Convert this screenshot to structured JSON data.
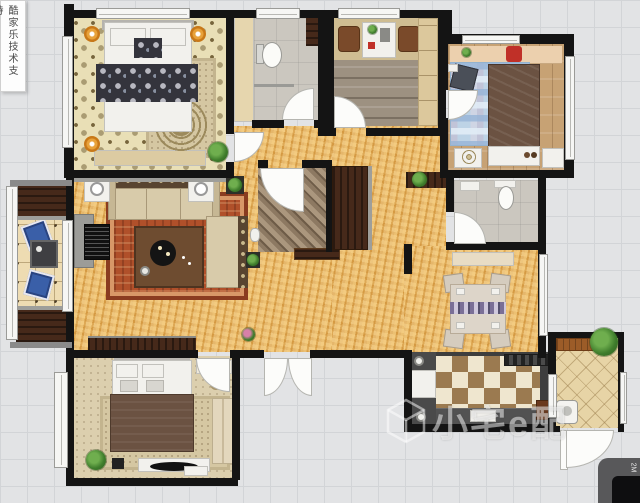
{
  "canvas": {
    "width_px": 640,
    "height_px": 503
  },
  "watermarks": {
    "side_vertical_text": "酷家乐技术支持",
    "brand_logo_text": "小宅e配",
    "corner_badge_text": "2M"
  },
  "palette": {
    "bg": "#e2e3e5",
    "grid": "#d2d4d7",
    "wall": "#141414",
    "gold": "#e2aa52",
    "damask": "#e9dfb6",
    "carpet": "#dccfae",
    "wood": "#c7a274",
    "plank": "#9d9181",
    "bath": "#cbc7bf",
    "kitchen_floor": "#3e3e3e",
    "tile_cream": "#efe6cf",
    "tile_brown": "#9b7a50",
    "rug_red": "#b0502a",
    "rug_blue": "#bdd3e6",
    "sofa": "#d8cbaa",
    "dark_wood": "#46291a",
    "bed_brown": "#6b5242",
    "accent_orange": "#e8a23a",
    "cushion_blue": "#3a5fa8",
    "chair_red": "#c03028",
    "plant_green": "#3f7d2c",
    "door": "#fcfcfa",
    "window": "#f6f6f4"
  }
}
